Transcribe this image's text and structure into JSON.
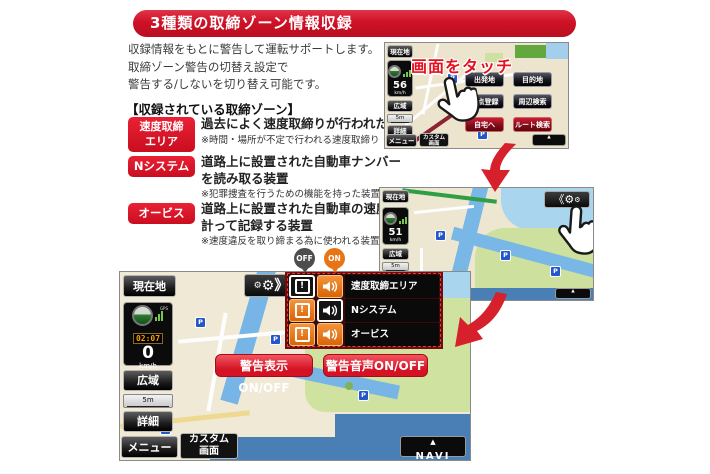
{
  "banner": {
    "title": "3種類の取締ゾーン情報収録"
  },
  "intro": {
    "line1": "収録情報をもとに警告して運転サポートします。",
    "line2": "取締ゾーン警告の切替え設定で",
    "line3": "警告する/しないを切り替え可能です。"
  },
  "zones": {
    "heading": "【収録されている取締ゾーン】",
    "items": [
      {
        "label": "速度取締エリア",
        "label_lines": [
          "速度取締",
          "エリア"
        ],
        "desc_lines": [
          "過去によく速度取締りが行われた場所",
          ""
        ],
        "note": "※時間・場所が不定で行われる速度取締り"
      },
      {
        "label": "Nシステム",
        "label_lines": [
          "Nシステム",
          ""
        ],
        "desc_lines": [
          "道路上に設置された自動車ナンバー",
          "を読み取る装置"
        ],
        "note": "※犯罪捜査を行うための機能を持った装置"
      },
      {
        "label": "オービス",
        "label_lines": [
          "オービス",
          ""
        ],
        "desc_lines": [
          "道路上に設置された自動車の速度を",
          "計って記録する装置"
        ],
        "note": "※速度違反を取り締まる為に使われる装置"
      }
    ]
  },
  "screen1": {
    "touch_callout": "画面をタッチ",
    "sidebar": {
      "current": "現在地",
      "gps": "GPS",
      "speed": "56",
      "unit": "km/h",
      "wide": "広域",
      "scale": "5m",
      "detail": "詳細",
      "menu": "メニュー",
      "custom1": "カスタム",
      "custom2": "画面"
    },
    "menu_buttons": [
      "出発地",
      "目的地",
      "地点登録",
      "周辺検索",
      "自宅へ",
      "ルート検索"
    ],
    "navi": "NAVI"
  },
  "screen2": {
    "sidebar": {
      "current": "現在地",
      "gps": "GPS",
      "speed": "51",
      "unit": "km/h",
      "wide": "広域",
      "scale": "5m"
    },
    "navi": "NAVI"
  },
  "screen3": {
    "sidebar": {
      "current": "現在地",
      "gps": "GPS",
      "clock": "02:07",
      "speed": "0",
      "unit": "km/h",
      "wide": "広域",
      "scale": "5m",
      "detail": "詳細",
      "menu": "メニュー",
      "custom1": "カスタム",
      "custom2": "画面"
    },
    "badges": {
      "off": "OFF",
      "on": "ON"
    },
    "toggles": [
      {
        "label": "速度取締エリア",
        "display": "off",
        "sound": "on"
      },
      {
        "label": "Nシステム",
        "display": "on",
        "sound": "off"
      },
      {
        "label": "オービス",
        "display": "on",
        "sound": "on"
      }
    ],
    "buttons": {
      "warn_display": "警告表示ON/OFF",
      "warn_sound": "警告音声ON/OFF"
    },
    "navi": "NAVI"
  },
  "icons": {
    "gear": "⚙",
    "chevron_open": "《",
    "chevron_close": "》",
    "navi_arrow": "▲",
    "parking": "P",
    "exclamation": "!"
  },
  "colors": {
    "banner_red": "#cf1126",
    "zone_label_red": "#dd1124",
    "accent_orange": "#e87414",
    "off_gray": "#4d4d4d",
    "warn_button_red": "#e5313f",
    "route_green": "#2f9e44",
    "water_blue": "#79b7e6"
  }
}
